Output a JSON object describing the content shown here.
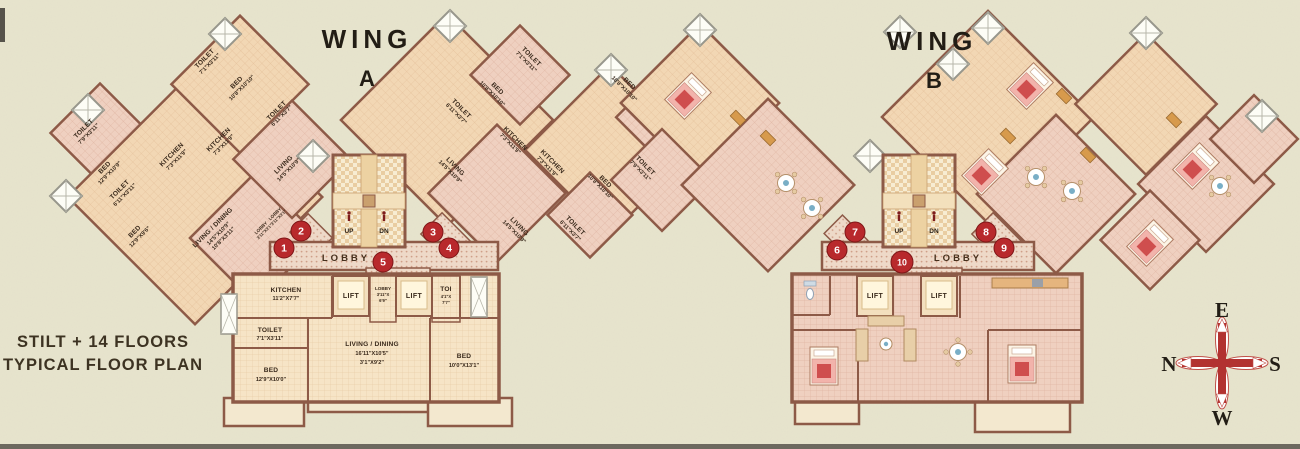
{
  "plan_title": {
    "line1": "STILT + 14 FLOORS",
    "line2": "TYPICAL FLOOR PLAN"
  },
  "wing_a": {
    "name": "WING",
    "letter": "A",
    "lobby_label": "LOBBY",
    "stairs": {
      "up": "UP",
      "dn": "DN"
    },
    "foyer": {
      "name": "LOBBY",
      "dim": "3'11\"X3'1\""
    },
    "rooms": [
      {
        "name": "TOILET",
        "dim": "7'9\"X3'11\""
      },
      {
        "name": "BED",
        "dim": "12'9\"X10'9\""
      },
      {
        "name": "TOILET",
        "dim": "6'11\"X3'11\""
      },
      {
        "name": "KITCHEN",
        "dim": "7'3\"X11'9\""
      },
      {
        "name": "BED",
        "dim": "12'9\"X9'6\""
      },
      {
        "name": "LIVING / DINING",
        "dim": "14'5\"X10'9\"",
        "dim2": "10'8\"X3'11\""
      },
      {
        "name": "TOILET",
        "dim": "7'1\"X3'11\""
      },
      {
        "name": "BED",
        "dim": "10'8\"X10'10\""
      },
      {
        "name": "TOILET",
        "dim": "6'11\"X3'7\""
      },
      {
        "name": "LIVING",
        "dim": "14'5\"X10'9\""
      },
      {
        "name": "KITCHEN",
        "dim": "7'3\"X11'9\""
      },
      {
        "name": "TOILET",
        "dim": "7'1\"X3'11\""
      },
      {
        "name": "BED",
        "dim": "10'8\"X10'10\""
      },
      {
        "name": "TOILET",
        "dim": "6'11\"X3'7\""
      },
      {
        "name": "KITCHEN",
        "dim": "7'3\"X11'9\""
      },
      {
        "name": "LIVING",
        "dim": "14'5\"X10'9\""
      },
      {
        "name": "KITCHEN",
        "dim": "7'3\"X11'9\""
      },
      {
        "name": "LIVING",
        "dim": "14'5\"X10'9\""
      },
      {
        "name": "TOILET",
        "dim": "6'11\"X3'7\""
      },
      {
        "name": "BED",
        "dim": "10'8\"X10'10\""
      },
      {
        "name": "BED",
        "dim": "10'8\"X10'10\""
      },
      {
        "name": "TOILET",
        "dim": "7'9\"X3'11\""
      }
    ]
  },
  "flat_a": {
    "rooms": [
      {
        "name": "KITCHEN",
        "dim": "11'2\"X7'7\""
      },
      {
        "name": "LIFT"
      },
      {
        "name": "LOBBY",
        "dim": "3'11\"X",
        "dim2": "6'9\""
      },
      {
        "name": "LIFT"
      },
      {
        "name": "TOI",
        "dim": "4'1\"X",
        "dim2": "7'7\""
      },
      {
        "name": "TOILET",
        "dim": "7'1\"X3'11\""
      },
      {
        "name": "LIVING / DINING",
        "dim": "16'11\"X10'5\"",
        "dim2": "3'1\"X9'2\""
      },
      {
        "name": "BED",
        "dim": "12'9\"X10'0\""
      },
      {
        "name": "BED",
        "dim": "10'0\"X13'1\""
      }
    ]
  },
  "wing_b": {
    "name": "WING",
    "letter": "B",
    "lobby_label": "LOBBY",
    "stairs": {
      "up": "UP",
      "dn": "DN"
    },
    "lifts": [
      "LIFT",
      "LIFT"
    ]
  },
  "markers": {
    "items": [
      "1",
      "2",
      "3",
      "4",
      "5",
      "6",
      "7",
      "8",
      "9",
      "10"
    ]
  },
  "compass": {
    "top": "E",
    "left": "N",
    "right": "S",
    "bottom": "W"
  },
  "colors": {
    "wall": "#8d5a47",
    "marker": "#b8292c",
    "compass_red": "#b23230",
    "paper": "#e7e4cd"
  }
}
